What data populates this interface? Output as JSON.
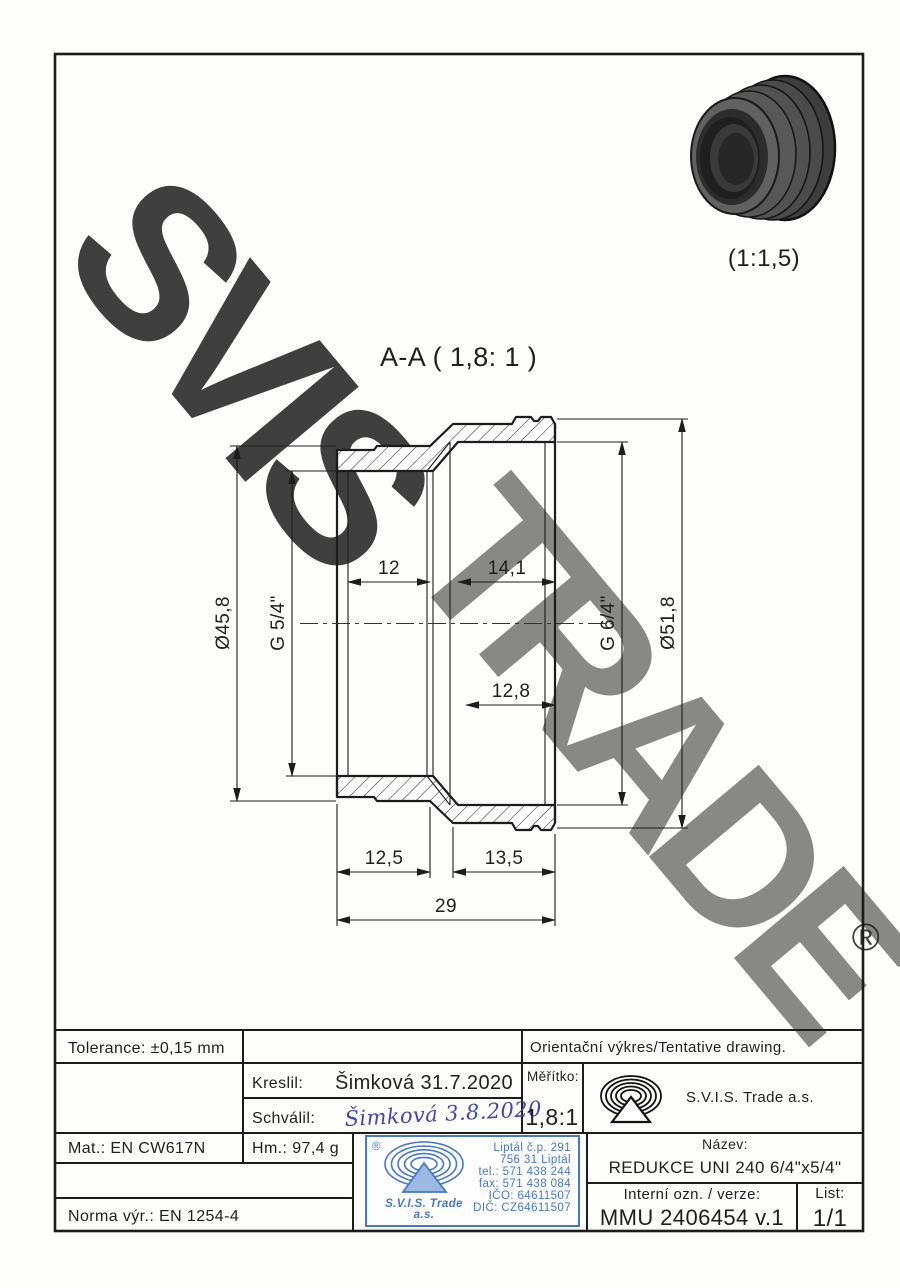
{
  "watermark": {
    "line1": "SVIS",
    "line2": "TRADE",
    "registered": "®",
    "gray": "#d2d2d2",
    "yellow": "#f4c14d"
  },
  "view3d": {
    "caption": "(1:1,5)"
  },
  "section": {
    "label": "A-A ( 1,8: 1 )",
    "dimensions": {
      "thread_len_left": "12",
      "thread_len_right": "14,1",
      "depth_right": "12,8",
      "outer_dia_left": "Ø45,8",
      "thread_left": "G 5/4\"",
      "thread_right": "G 6/4\"",
      "outer_dia_right": "Ø51,8",
      "len_left": "12,5",
      "len_right": "13,5",
      "len_total": "29"
    }
  },
  "title_block": {
    "tolerance": "Tolerance: ±0,15 mm",
    "orientation_note": "Orientační výkres/Tentative drawing.",
    "kreslil_label": "Kreslil:",
    "kreslil_value": "Šimková 31.7.2020",
    "schvalil_label": "Schválil:",
    "schvalil_signature": "Šimková 3.8.2020",
    "meritko_label": "Měřítko:",
    "meritko_value": "1,8:1",
    "company": "S.V.I.S. Trade a.s.",
    "mat": "Mat.: EN CW617N",
    "hm": "Hm.: 97,4 g",
    "norma": "Norma výr.: EN 1254-4",
    "nazev_label": "Název:",
    "nazev_value": "REDUKCE UNI 240 6/4\"x5/4\"",
    "interni_label": "Interní ozn. / verze:",
    "interni_value": "MMU 2406454 v.1",
    "list_label": "List:",
    "list_value": "1/1"
  },
  "stamp": {
    "registered": "®",
    "company_line1": "S.V.I.S. Trade",
    "company_line2": "a.s.",
    "lines": [
      "Liptál č.p. 291",
      "756 31 Liptál",
      "tel.: 571 438 244",
      "fax: 571 438 084",
      "IČO: 64611507",
      "DIČ: CZ64611507"
    ],
    "color": "#4677c8"
  }
}
